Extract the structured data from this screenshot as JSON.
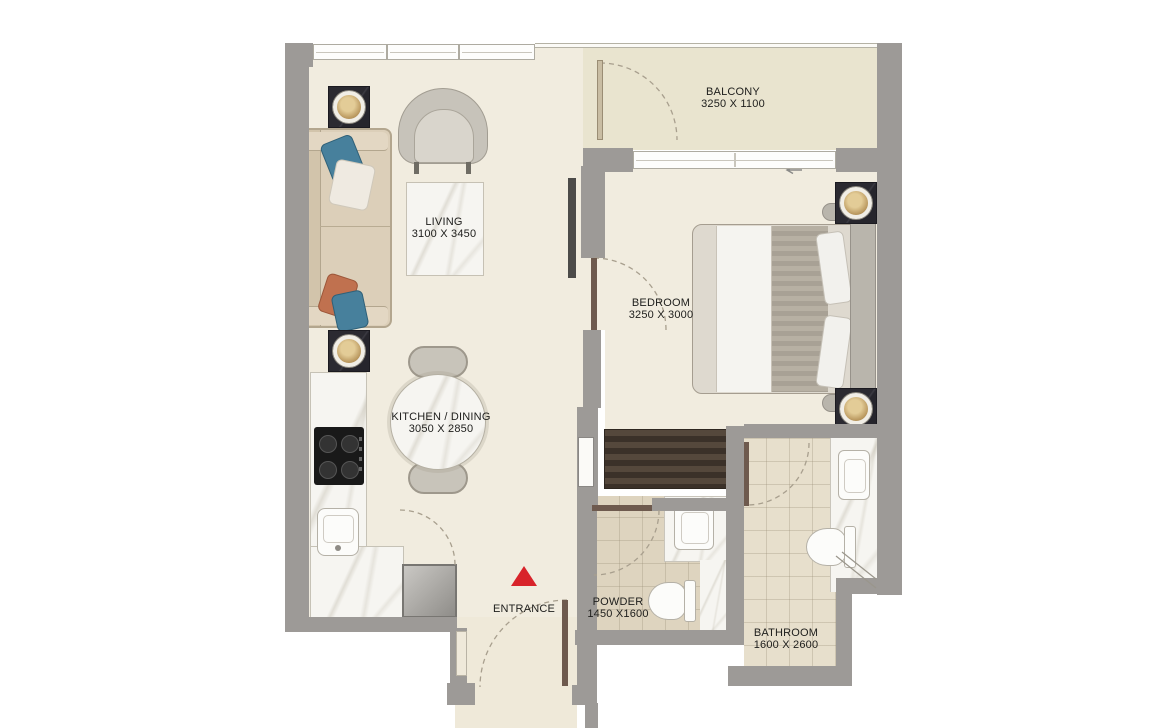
{
  "palette": {
    "wall": "#9d9a97",
    "floor_interior": "#f1ecdf",
    "floor_balcony": "#e9e4cf",
    "floor_tile_bathroom": "#e7dfcc",
    "floor_tile_powder": "#ded4bf",
    "counter_marble": "#f6f5f1",
    "wardrobe": "#4a3f35",
    "door_leaf": "#6e5a4e",
    "entrance_marker": "#d8232a",
    "label_text": "#20201e"
  },
  "rooms": [
    {
      "id": "balcony",
      "name": "BALCONY",
      "dims": "3250 X 1100"
    },
    {
      "id": "living",
      "name": "LIVING",
      "dims": "3100 X 3450"
    },
    {
      "id": "bedroom",
      "name": "BEDROOM",
      "dims": "3250 X 3000"
    },
    {
      "id": "kitchen_dining",
      "name": "KITCHEN / DINING",
      "dims": "3050 X 2850"
    },
    {
      "id": "entrance",
      "name": "ENTRANCE",
      "dims": ""
    },
    {
      "id": "powder",
      "name": "POWDER",
      "dims": "1450 X1600"
    },
    {
      "id": "bathroom",
      "name": "BATHROOM",
      "dims": "1600 X 2600"
    }
  ],
  "icons": {
    "entrance_marker": "red-triangle",
    "bedroom_window_arrow": "left-arrow"
  }
}
